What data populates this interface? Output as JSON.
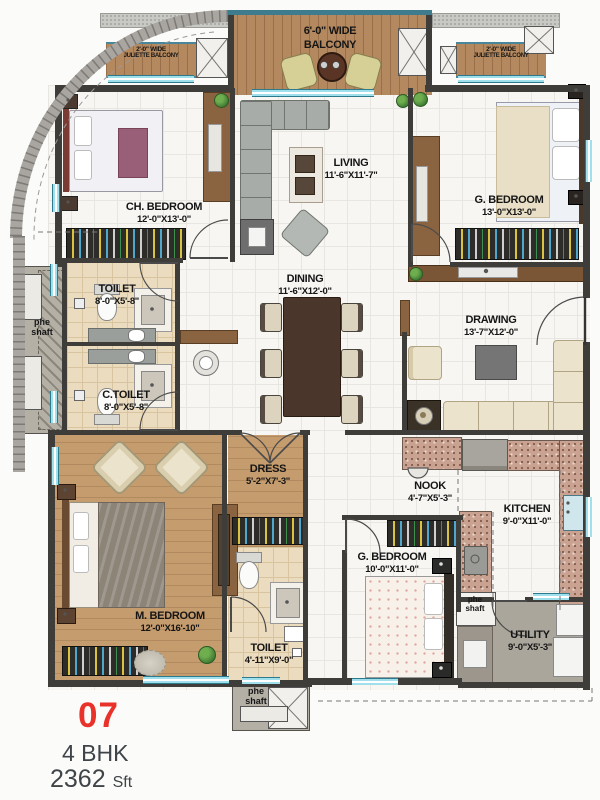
{
  "unit": {
    "number": "07",
    "type": "4 BHK",
    "area_value": "2362",
    "area_unit": "Sft"
  },
  "rooms": {
    "balcony": {
      "line1": "6'-0\" WIDE",
      "line2": "BALCONY"
    },
    "juliette_left": {
      "line1": "2'-0\" WIDE",
      "line2": "JULIETTE BALCONY"
    },
    "juliette_right": {
      "line1": "2'-0\" WIDE",
      "line2": "JULIETTE BALCONY"
    },
    "ch_bedroom": {
      "line1": "CH. BEDROOM",
      "line2": "12'-0\"X13'-0\""
    },
    "living": {
      "line1": "LIVING",
      "line2": "11'-6\"X11'-7\""
    },
    "g_bedroom_top": {
      "line1": "G. BEDROOM",
      "line2": "13'-0\"X13'-0\""
    },
    "toilet_top": {
      "line1": "TOILET",
      "line2": "8'-0\"X5'-8\""
    },
    "c_toilet": {
      "line1": "C.TOILET",
      "line2": "8'-0\"X5'-8\""
    },
    "dining": {
      "line1": "DINING",
      "line2": "11'-6\"X12'-0\""
    },
    "drawing": {
      "line1": "DRAWING",
      "line2": "13'-7\"X12'-0\""
    },
    "m_bedroom": {
      "line1": "M. BEDROOM",
      "line2": "12'-0\"X16'-10\""
    },
    "dress": {
      "line1": "DRESS",
      "line2": "5'-2\"X7'-3\""
    },
    "toilet_m": {
      "line1": "TOILET",
      "line2": "4'-11\"X9'-0\""
    },
    "nook": {
      "line1": "NOOK",
      "line2": "4'-7\"X5'-3\""
    },
    "g_bedroom_bottom": {
      "line1": "G. BEDROOM",
      "line2": "10'-0\"X11'-0\""
    },
    "kitchen": {
      "line1": "KITCHEN",
      "line2": "9'-0\"X11'-0\""
    },
    "utility": {
      "line1": "UTILITY",
      "line2": "9'-0\"X5'-3\""
    },
    "shaft_left": {
      "line1": "phe",
      "line2": "shaft"
    },
    "shaft_bottom": {
      "line1": "phe",
      "line2": "shaft"
    },
    "shaft_right": {
      "line1": "phe",
      "line2": "shaft"
    }
  },
  "colors": {
    "accent_red": "#e8322a",
    "window_teal": "#9fe0ec",
    "wall": "#3f3d3a"
  }
}
